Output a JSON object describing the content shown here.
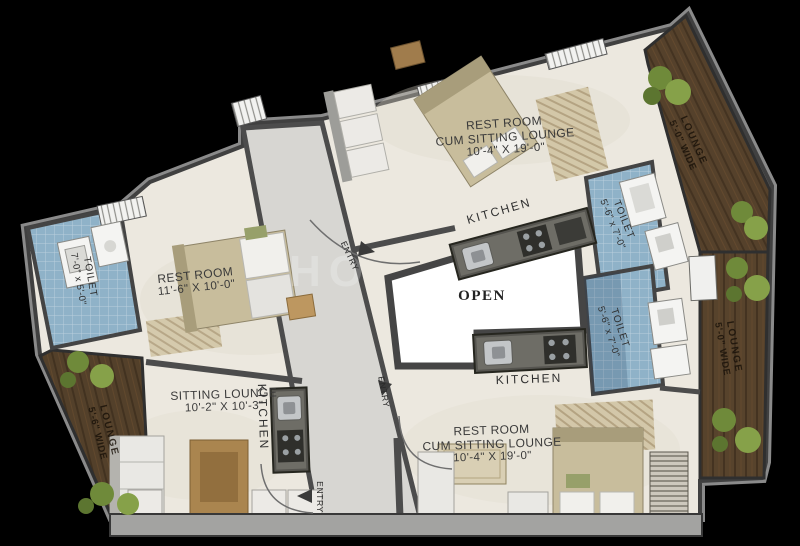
{
  "watermark": "HO",
  "rooms": {
    "restroom_top_right": {
      "line1": "REST ROOM",
      "line2": "CUM SITTING LOUNGE",
      "dims": "10'-4\" X 19'-0\""
    },
    "restroom_bottom_right": {
      "line1": "REST ROOM",
      "line2": "CUM SITTING LOUNGE",
      "dims": "10'-4\" X 19'-0\""
    },
    "restroom_left": {
      "name": "REST ROOM",
      "dims": "11'-6\" X 10'-0\""
    },
    "sitting_lounge": {
      "name": "SITTING LOUNGE",
      "dims": "10'-2\" X 10'-3\""
    },
    "open_area": {
      "name": "OPEN"
    },
    "kitchen_top": {
      "name": "KITCHEN"
    },
    "kitchen_bottom": {
      "name": "KITCHEN"
    },
    "kitchen_left": {
      "name": "KITCHEN"
    },
    "toilet_left": {
      "name": "TOILET",
      "dims": "7'-0\" x 5'-0\""
    },
    "toilet_upper_right": {
      "name": "TOILET",
      "dims": "5'-6\" x 7'-0\""
    },
    "toilet_lower_right": {
      "name": "TOILET",
      "dims": "5'-6\" x 7'-0\""
    },
    "lounge_top_right": {
      "name": "LOUNGE",
      "dims": "5'-0\" WIDE"
    },
    "lounge_right": {
      "name": "LOUNGE",
      "dims": "5'-0\" WIDE"
    },
    "lounge_bottom_left": {
      "name": "LOUNGE",
      "dims": "5'-6\" WIDE"
    }
  },
  "entries": {
    "top": "ENTRY",
    "middle": "ENTRY",
    "bottom": "ENTRY"
  },
  "colors": {
    "background": "#000000",
    "floor": "#ece8df",
    "corridor": "#d7d6d2",
    "wall": "#4a4a4a",
    "toilet_tile": "#8fb2c8",
    "balcony_wood": "#55412b",
    "open_area": "#ffffff",
    "plant": "#7c9440"
  }
}
